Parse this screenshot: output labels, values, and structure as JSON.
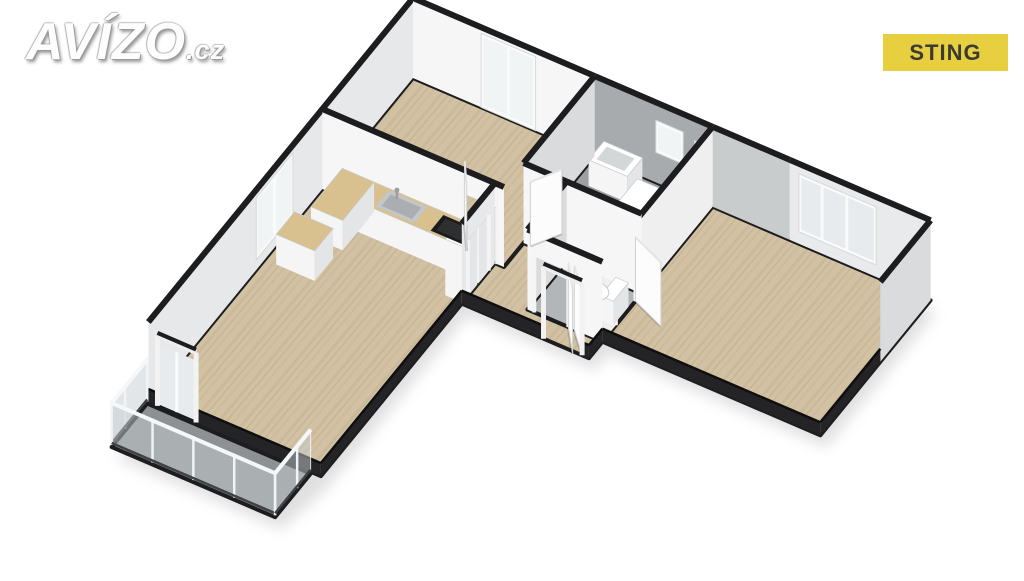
{
  "branding": {
    "logo_main": "AVÍZO",
    "logo_suffix": ".cz"
  },
  "badge": {
    "label": "STING",
    "bg": "#e8cf40",
    "fg": "#3b3a33"
  },
  "palette": {
    "background": "#ffffff",
    "dark": "#1d1d1f",
    "lowWall": "#242427",
    "wood": "#d2c1a3",
    "woodStripeA": "#cab99a",
    "woodStripeB": "#ccbc9d",
    "woodStripeC": "#c7b695",
    "counterWood": "#d9c08f",
    "tile": "#9da0a2",
    "tileLight": "#b3b6b8",
    "balconyFloor": "#8e9193",
    "wallBright": "#f6f6f6",
    "wallLight": "#e9eaeb",
    "wallLight2": "#efefef",
    "wallMid": "#e7e8e9",
    "wallShade": "#d9dbdc",
    "wallShade2": "#c9cccd",
    "wallGray": "#a8abad",
    "white": "#ffffff",
    "pane": "#e7ebed",
    "paneBright": "#f0f4f5",
    "steel": "#c3c7c9",
    "steelDark": "#aaaeb0",
    "black": "#1b1b1b",
    "blackSoft": "#2e2f30",
    "glass": "rgba(198,206,210,0.5)",
    "shadow": "rgba(0,0,0,0.12)"
  },
  "floorplan": {
    "projection": {
      "origin": [
        413,
        78
      ],
      "ex": [
        45.4,
        19.5
      ],
      "ey": [
        -24.5,
        30
      ],
      "wall_px": 80,
      "low_px": 13
    },
    "silhouette": [
      [
        0,
        0
      ],
      [
        11.4,
        0
      ],
      [
        11.4,
        4.5
      ],
      [
        6.6,
        4.5
      ],
      [
        6.6,
        5.05
      ],
      [
        3.8,
        5.05
      ],
      [
        3.8,
        10.85
      ],
      [
        3.6,
        12.3
      ],
      [
        0,
        12.3
      ]
    ],
    "rooms": [
      {
        "name": "bedroom-1",
        "floor": "wood",
        "poly": [
          [
            0,
            0
          ],
          [
            4,
            0
          ],
          [
            4,
            3.7
          ],
          [
            0,
            3.7
          ]
        ]
      },
      {
        "name": "bathroom",
        "floor": "tile",
        "poly": [
          [
            4,
            0
          ],
          [
            6.6,
            0
          ],
          [
            6.6,
            2.9
          ],
          [
            4,
            2.9
          ]
        ]
      },
      {
        "name": "wc",
        "floor": "tile-light",
        "poly": [
          [
            4.95,
            2.9
          ],
          [
            6.6,
            2.9
          ],
          [
            6.6,
            4.5
          ],
          [
            4.95,
            4.5
          ]
        ]
      },
      {
        "name": "bedroom-2",
        "floor": "wood",
        "poly": [
          [
            6.6,
            0
          ],
          [
            11.4,
            0
          ],
          [
            11.4,
            4.5
          ],
          [
            6.6,
            4.5
          ]
        ]
      },
      {
        "name": "hallway",
        "floor": "wood",
        "poly": [
          [
            4,
            2.9
          ],
          [
            4.95,
            2.9
          ],
          [
            4.95,
            4.5
          ],
          [
            6.6,
            4.5
          ],
          [
            6.6,
            5.05
          ],
          [
            3.8,
            5.05
          ],
          [
            3.8,
            3.7
          ],
          [
            4,
            3.7
          ]
        ]
      },
      {
        "name": "living-room-kitchen",
        "floor": "wood",
        "poly": [
          [
            0,
            3.7
          ],
          [
            3.8,
            3.7
          ],
          [
            3.8,
            10.8
          ],
          [
            0,
            10.8
          ]
        ]
      },
      {
        "name": "balcony",
        "floor": "concrete",
        "poly": [
          [
            0,
            10.85
          ],
          [
            3.6,
            10.85
          ],
          [
            3.6,
            12.3
          ],
          [
            0,
            12.3
          ]
        ]
      }
    ],
    "walls": [
      {
        "name": "wall-west",
        "a": [
          0,
          0
        ],
        "b": [
          0,
          10.8
        ],
        "kind": "full",
        "fill": "wallMid",
        "windows": [
          {
            "from": 4.9,
            "to": 6.4,
            "z": [
              10,
              72
            ],
            "mullions": [
              0.5
            ],
            "pane": "paneBright"
          }
        ]
      },
      {
        "name": "wall-north-bedroom1",
        "a": [
          0,
          0
        ],
        "b": [
          4,
          0
        ],
        "kind": "full",
        "fill": "wallBright",
        "windows": [
          {
            "from": 1.5,
            "to": 2.7,
            "z": [
              0,
              74
            ],
            "mullions": [
              0.5
            ],
            "pane": "paneBright"
          }
        ]
      },
      {
        "name": "wall-north-bathroom",
        "a": [
          4,
          0
        ],
        "b": [
          6.6,
          0
        ],
        "kind": "full",
        "fill": "wallGray",
        "windows": [
          {
            "from": 1.35,
            "to": 1.95,
            "z": [
              30,
              62
            ],
            "pane": "paneBright"
          },
          {
            "from": 2.2,
            "to": 2.5,
            "z": [
              40,
              58
            ],
            "pane": "white"
          }
        ]
      },
      {
        "name": "wall-north-bedroom2-left",
        "a": [
          6.6,
          0
        ],
        "b": [
          8.3,
          0
        ],
        "kind": "full",
        "fill": "wallShade2"
      },
      {
        "name": "wall-north-bedroom2",
        "a": [
          8.3,
          0
        ],
        "b": [
          11.4,
          0
        ],
        "kind": "full",
        "fill": "wallLight",
        "windows": [
          {
            "from": 0.2,
            "to": 1.9,
            "z": [
              12,
              70
            ],
            "mullions": [
              0.3,
              0.62
            ],
            "pane": "pane"
          }
        ]
      },
      {
        "name": "wall-east-bedroom2",
        "a": [
          11.4,
          0
        ],
        "b": [
          11.4,
          2.05
        ],
        "kind": "full",
        "fill": "wallShade"
      },
      {
        "name": "wall-bedroom1-bathroom",
        "a": [
          4,
          0
        ],
        "b": [
          4,
          2.9
        ],
        "kind": "full",
        "fill": "wallShade"
      },
      {
        "name": "wall-bedroom1-south",
        "a": [
          0,
          3.7
        ],
        "b": [
          4,
          3.7
        ],
        "kind": "full",
        "fill": "wallBright",
        "gaps": [
          {
            "from": 3.1,
            "to": 3.85
          }
        ]
      },
      {
        "name": "wall-bathroom-south",
        "a": [
          4,
          2.9
        ],
        "b": [
          6.6,
          2.9
        ],
        "kind": "full",
        "fill": "wallBright",
        "gaps": [
          {
            "from": 0.15,
            "to": 0.9
          }
        ]
      },
      {
        "name": "wall-wc-west",
        "a": [
          4.95,
          2.9
        ],
        "b": [
          4.95,
          4.5
        ],
        "kind": "full",
        "fill": "wallShade"
      },
      {
        "name": "wall-bedroom2-west",
        "a": [
          6.6,
          0
        ],
        "b": [
          6.6,
          4.5
        ],
        "kind": "full",
        "fill": "wallLight2",
        "gaps": [
          {
            "from": 3.15,
            "to": 3.95
          }
        ]
      },
      {
        "name": "wall-wc-south",
        "a": [
          4.95,
          4.5
        ],
        "b": [
          6.6,
          4.5
        ],
        "kind": "full",
        "fill": "wallBright",
        "gaps": [
          {
            "from": 0.15,
            "to": 0.9
          }
        ]
      },
      {
        "name": "wall-living-hall",
        "a": [
          3.8,
          3.7
        ],
        "b": [
          3.8,
          5.05
        ],
        "kind": "full",
        "fill": "wallMid",
        "gaps": [
          {
            "from": 0.25,
            "to": 1.1
          }
        ]
      },
      {
        "name": "lowwall-living-east",
        "a": [
          3.8,
          5.05
        ],
        "b": [
          3.8,
          10.8
        ],
        "kind": "low"
      },
      {
        "name": "lowwall-living-south",
        "a": [
          0,
          10.8
        ],
        "b": [
          3.8,
          10.8
        ],
        "kind": "low",
        "gaps": [
          {
            "from": 0.2,
            "to": 1.05
          }
        ]
      },
      {
        "name": "lowwall-hall-south",
        "a": [
          3.8,
          5.05
        ],
        "b": [
          6.6,
          5.05
        ],
        "kind": "low",
        "gaps": [
          {
            "from": 1.8,
            "to": 2.65
          }
        ]
      },
      {
        "name": "lowwall-hall-step",
        "a": [
          6.6,
          5.05
        ],
        "b": [
          6.6,
          4.5
        ],
        "kind": "low"
      },
      {
        "name": "lowwall-bedroom2-south",
        "a": [
          6.6,
          4.5
        ],
        "b": [
          11.4,
          4.5
        ],
        "kind": "low"
      },
      {
        "name": "lowwall-bedroom2-east",
        "a": [
          11.4,
          2.05
        ],
        "b": [
          11.4,
          4.5
        ],
        "kind": "low"
      }
    ],
    "fixtures": [
      {
        "type": "box",
        "name": "kitchen-counter-run",
        "min": [
          1.15,
          3.72
        ],
        "max": [
          3.8,
          4.38
        ],
        "h": 30,
        "top": "counterWood"
      },
      {
        "type": "box",
        "name": "kitchen-counter-leg",
        "min": [
          0.45,
          3.72
        ],
        "max": [
          1.15,
          5.0
        ],
        "h": 30,
        "top": "counterWood"
      },
      {
        "type": "box",
        "name": "kitchen-island",
        "min": [
          0.25,
          5.3
        ],
        "max": [
          1.1,
          6.05
        ],
        "h": 30,
        "top": "counterWood"
      },
      {
        "type": "box",
        "name": "kitchen-tall-cabinet",
        "min": [
          3.42,
          3.72
        ],
        "max": [
          3.8,
          4.35
        ],
        "h": 56,
        "top": "white"
      },
      {
        "type": "box",
        "name": "kitchen-tall-cabinet-2",
        "min": [
          3.42,
          4.42
        ],
        "max": [
          3.8,
          5.02
        ],
        "h": 56,
        "top": "white"
      },
      {
        "type": "rectTop",
        "name": "kitchen-sink",
        "min": [
          1.5,
          3.78
        ],
        "max": [
          2.35,
          4.3
        ],
        "z": 30,
        "fill": "steel",
        "inner": "steelDark",
        "faucet": true
      },
      {
        "type": "rectTop",
        "name": "cooktop",
        "min": [
          2.72,
          3.8
        ],
        "max": [
          3.42,
          4.32
        ],
        "z": 30,
        "fill": "black",
        "inner": "blackSoft"
      },
      {
        "type": "box",
        "name": "washing-machine",
        "min": [
          5.45,
          0.95
        ],
        "max": [
          6.2,
          1.75
        ],
        "h": 34,
        "top": "white",
        "porthole": true
      },
      {
        "type": "box",
        "name": "bathroom-sink",
        "min": [
          4.3,
          0.18
        ],
        "max": [
          5.15,
          0.8
        ],
        "h": 26,
        "top": "white",
        "basin": true
      },
      {
        "type": "toilet",
        "name": "toilet",
        "center": [
          5.95,
          3.68
        ],
        "ru": 0.32,
        "rv": 0.27,
        "tank": {
          "min": [
            6.28,
            3.36
          ],
          "max": [
            6.56,
            3.98
          ],
          "h": 24
        }
      }
    ],
    "doors": [
      {
        "name": "bedroom1-door",
        "hinge": [
          3.18,
          3.7
        ],
        "end": [
          2.8,
          3.08
        ]
      },
      {
        "name": "bathroom-door",
        "hinge": [
          4.15,
          2.9
        ],
        "end": [
          4.5,
          2.26
        ]
      },
      {
        "name": "wc-door",
        "hinge": [
          5.85,
          4.5
        ],
        "end": [
          6.28,
          5.12
        ]
      },
      {
        "name": "bedroom2-door",
        "hinge": [
          6.6,
          3.15
        ],
        "end": [
          7.35,
          3.5
        ]
      },
      {
        "name": "entrance-door",
        "hinge": [
          6.45,
          5.05
        ],
        "end": [
          5.98,
          4.5
        ]
      }
    ],
    "tall_frames": [
      {
        "name": "entrance-door-frame",
        "a": [
          5.6,
          5.05
        ],
        "b": [
          6.45,
          5.05
        ],
        "h": 72
      },
      {
        "name": "balcony-door-frame",
        "a": [
          0.2,
          10.8
        ],
        "b": [
          1.05,
          10.8
        ],
        "h": 70,
        "pane": "pane",
        "mullion": 0.5
      }
    ],
    "railing": {
      "name": "balcony-railing",
      "h": 44,
      "post_step": 0.9,
      "edges": [
        {
          "a": [
            0,
            10.85
          ],
          "b": [
            0,
            12.3
          ]
        },
        {
          "a": [
            0,
            12.3
          ],
          "b": [
            3.6,
            12.3
          ]
        },
        {
          "a": [
            3.6,
            12.3
          ],
          "b": [
            3.6,
            10.85
          ]
        }
      ]
    }
  }
}
